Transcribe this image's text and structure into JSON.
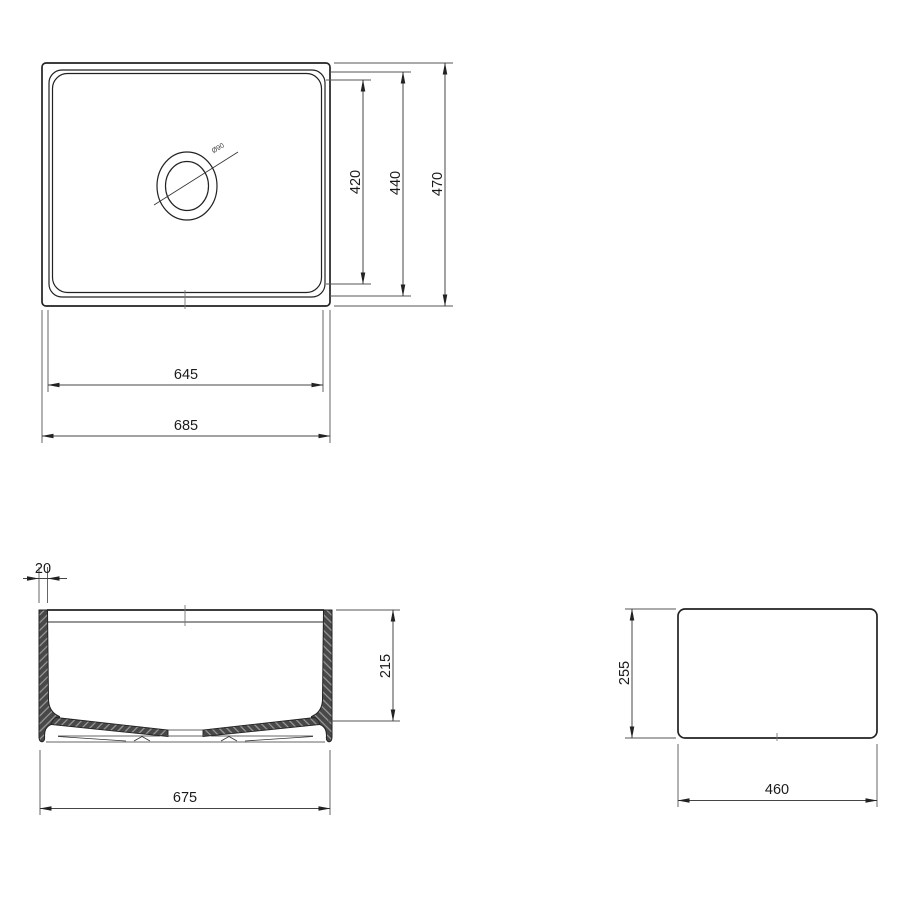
{
  "colors": {
    "background": "#ffffff",
    "outline": "#222222",
    "dimension_line": "#444444",
    "text": "#1b1b1b",
    "wall_fill": "#484848",
    "hatch_line": "#a3a3a3"
  },
  "views": {
    "top_view": {
      "dimensions": {
        "bowl_width": "420",
        "rim_width": "440",
        "overall_depth": "470",
        "bowl_length": "645",
        "overall_length": "685",
        "drain_diameter": "Ø90"
      }
    },
    "front_section_view": {
      "dimensions": {
        "wall_thickness": "20",
        "bowl_depth": "215",
        "base_length": "675"
      }
    },
    "side_view": {
      "dimensions": {
        "overall_height": "255",
        "overall_depth": "460"
      }
    }
  }
}
